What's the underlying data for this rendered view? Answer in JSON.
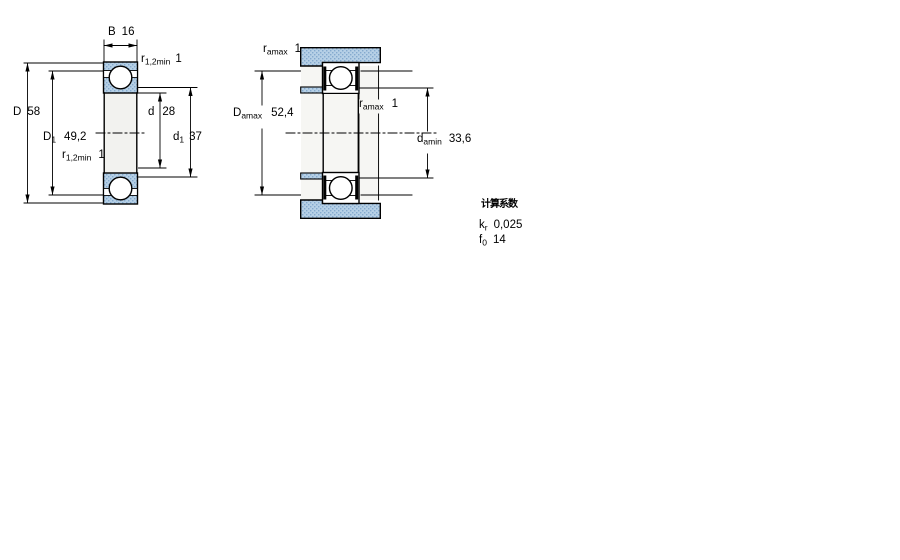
{
  "left_figure": {
    "labels": {
      "B": {
        "sym": "B",
        "value": "16"
      },
      "r12_top": {
        "sym": "r",
        "sub": "1,2min",
        "value": "1"
      },
      "D": {
        "sym": "D",
        "value": "58"
      },
      "D1": {
        "sym": "D",
        "sub": "1",
        "value": "49,2"
      },
      "r12_bottom": {
        "sym": "r",
        "sub": "1,2min",
        "value": "1"
      },
      "d": {
        "sym": "d",
        "value": "28"
      },
      "d1": {
        "sym": "d",
        "sub": "1",
        "value": "37"
      }
    }
  },
  "right_figure": {
    "labels": {
      "ra_top": {
        "sym": "r",
        "sub": "amax",
        "value": "1"
      },
      "Da": {
        "sym": "D",
        "sub": "amax",
        "value": "52,4"
      },
      "ra_mid": {
        "sym": "r",
        "sub": "amax",
        "value": "1"
      },
      "da": {
        "sym": "d",
        "sub": "amin",
        "value": "33,6"
      }
    }
  },
  "calculation_factors": {
    "title": "计算系数",
    "rows": [
      {
        "sym": "k",
        "sub": "r",
        "value": "0,025"
      },
      {
        "sym": "f",
        "sub": "0",
        "value": "14"
      }
    ]
  },
  "colors": {
    "hatch_base": "#b6d0e6",
    "hatch_dot": "#84aace",
    "bore_fill": "#f2f2ef",
    "line": "#000000"
  }
}
